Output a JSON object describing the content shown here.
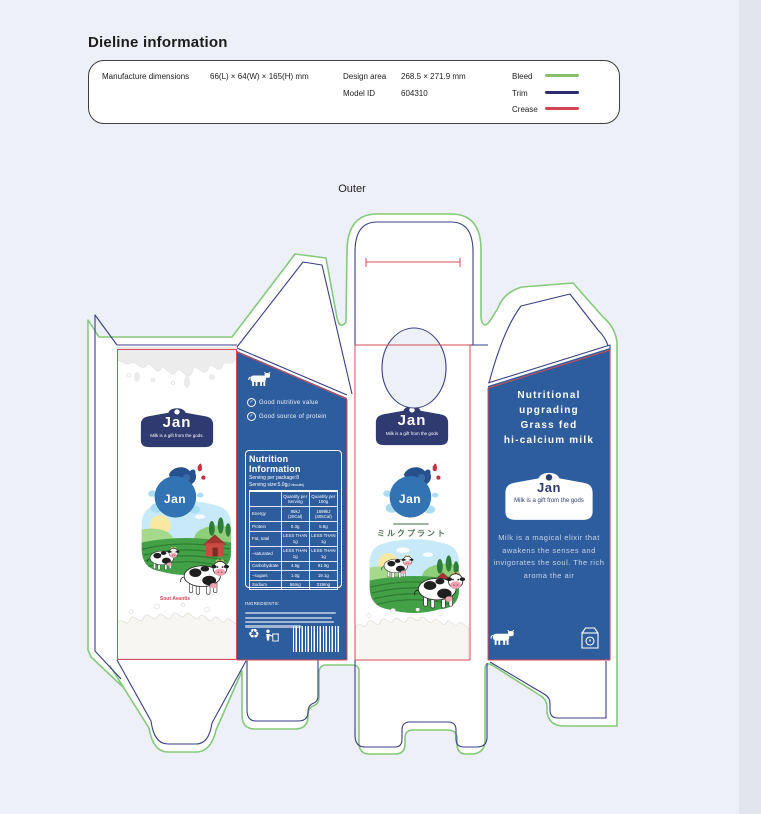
{
  "page": {
    "title": "Dieline information",
    "section_label": "Outer"
  },
  "info_panel": {
    "manufacture_dimensions": {
      "label": "Manufacture dimensions",
      "value": "66(L) × 64(W) × 165(H) mm"
    },
    "design_area": {
      "label": "Design area",
      "value": "268.5 × 271.9 mm"
    },
    "model_id": {
      "label": "Model ID",
      "value": "604310"
    },
    "legend": [
      {
        "label": "Bleed",
        "color": "#85c06c"
      },
      {
        "label": "Trim",
        "color": "#2b2d6e"
      },
      {
        "label": "Crease",
        "color": "#d3454f"
      }
    ]
  },
  "dieline": {
    "colors": {
      "bleed": "#85c97c",
      "trim": "#3a3f85",
      "crease": "#d84b57",
      "panel_blue": "#2e5d9e",
      "badge_navy": "#2e3a70",
      "circle_blue": "#3273b4"
    }
  },
  "panels": {
    "front_left": {
      "brand": "Jan",
      "tagline": "Milk is a gift from the gods.",
      "circle_label": "Jan",
      "accent_text": "Sout Avantis"
    },
    "nutrition": {
      "bullets": [
        "Good nutritive value",
        "Good source of protein"
      ],
      "title": "Nutrition Information",
      "serving_line1": "Serving per package:8",
      "serving_line2": "Serving size:5.0g",
      "serving_line2_suffix": "(2 biscuits)",
      "columns": [
        "",
        "Quantity per\nServing",
        "Quantity per\n100g"
      ],
      "rows": [
        {
          "label": "Energy",
          "per_serving": "85kJ\n(20Cal)",
          "per_100g": "1699kJ\n(405Cal)"
        },
        {
          "label": "Protein",
          "per_serving": "0.3g",
          "per_100g": "5.8g"
        },
        {
          "label": "Fat, total",
          "per_serving": "LESS THAN 1g",
          "per_100g": "LESS THAN 1g"
        },
        {
          "label": "–saturated",
          "per_serving": "LESS THAN 1g",
          "per_100g": "LESS THAN 1g"
        },
        {
          "label": "Carbohydrate",
          "per_serving": "4.6g",
          "per_100g": "91.9g"
        },
        {
          "label": "–sugars",
          "per_serving": "1.0g",
          "per_100g": "19.1g"
        },
        {
          "label": "Sodium",
          "per_serving": "56mg",
          "per_100g": "319mg"
        }
      ],
      "ingredients_label": "INGREDIENTS:"
    },
    "front_center": {
      "brand": "Jan",
      "tagline": "Milk is a gift from the gods",
      "circle_label": "Jan",
      "japanese_text": "ミルクプラント"
    },
    "side_right": {
      "headline": "Nutritional\nupgrading\nGrass fed\nhi-calcium milk",
      "badge_brand": "Jan",
      "badge_tagline": "Milk is a gift from the gods",
      "body": "Milk is a magical elixir that awakens the senses and invigorates the soul. The rich aroma the air"
    }
  }
}
